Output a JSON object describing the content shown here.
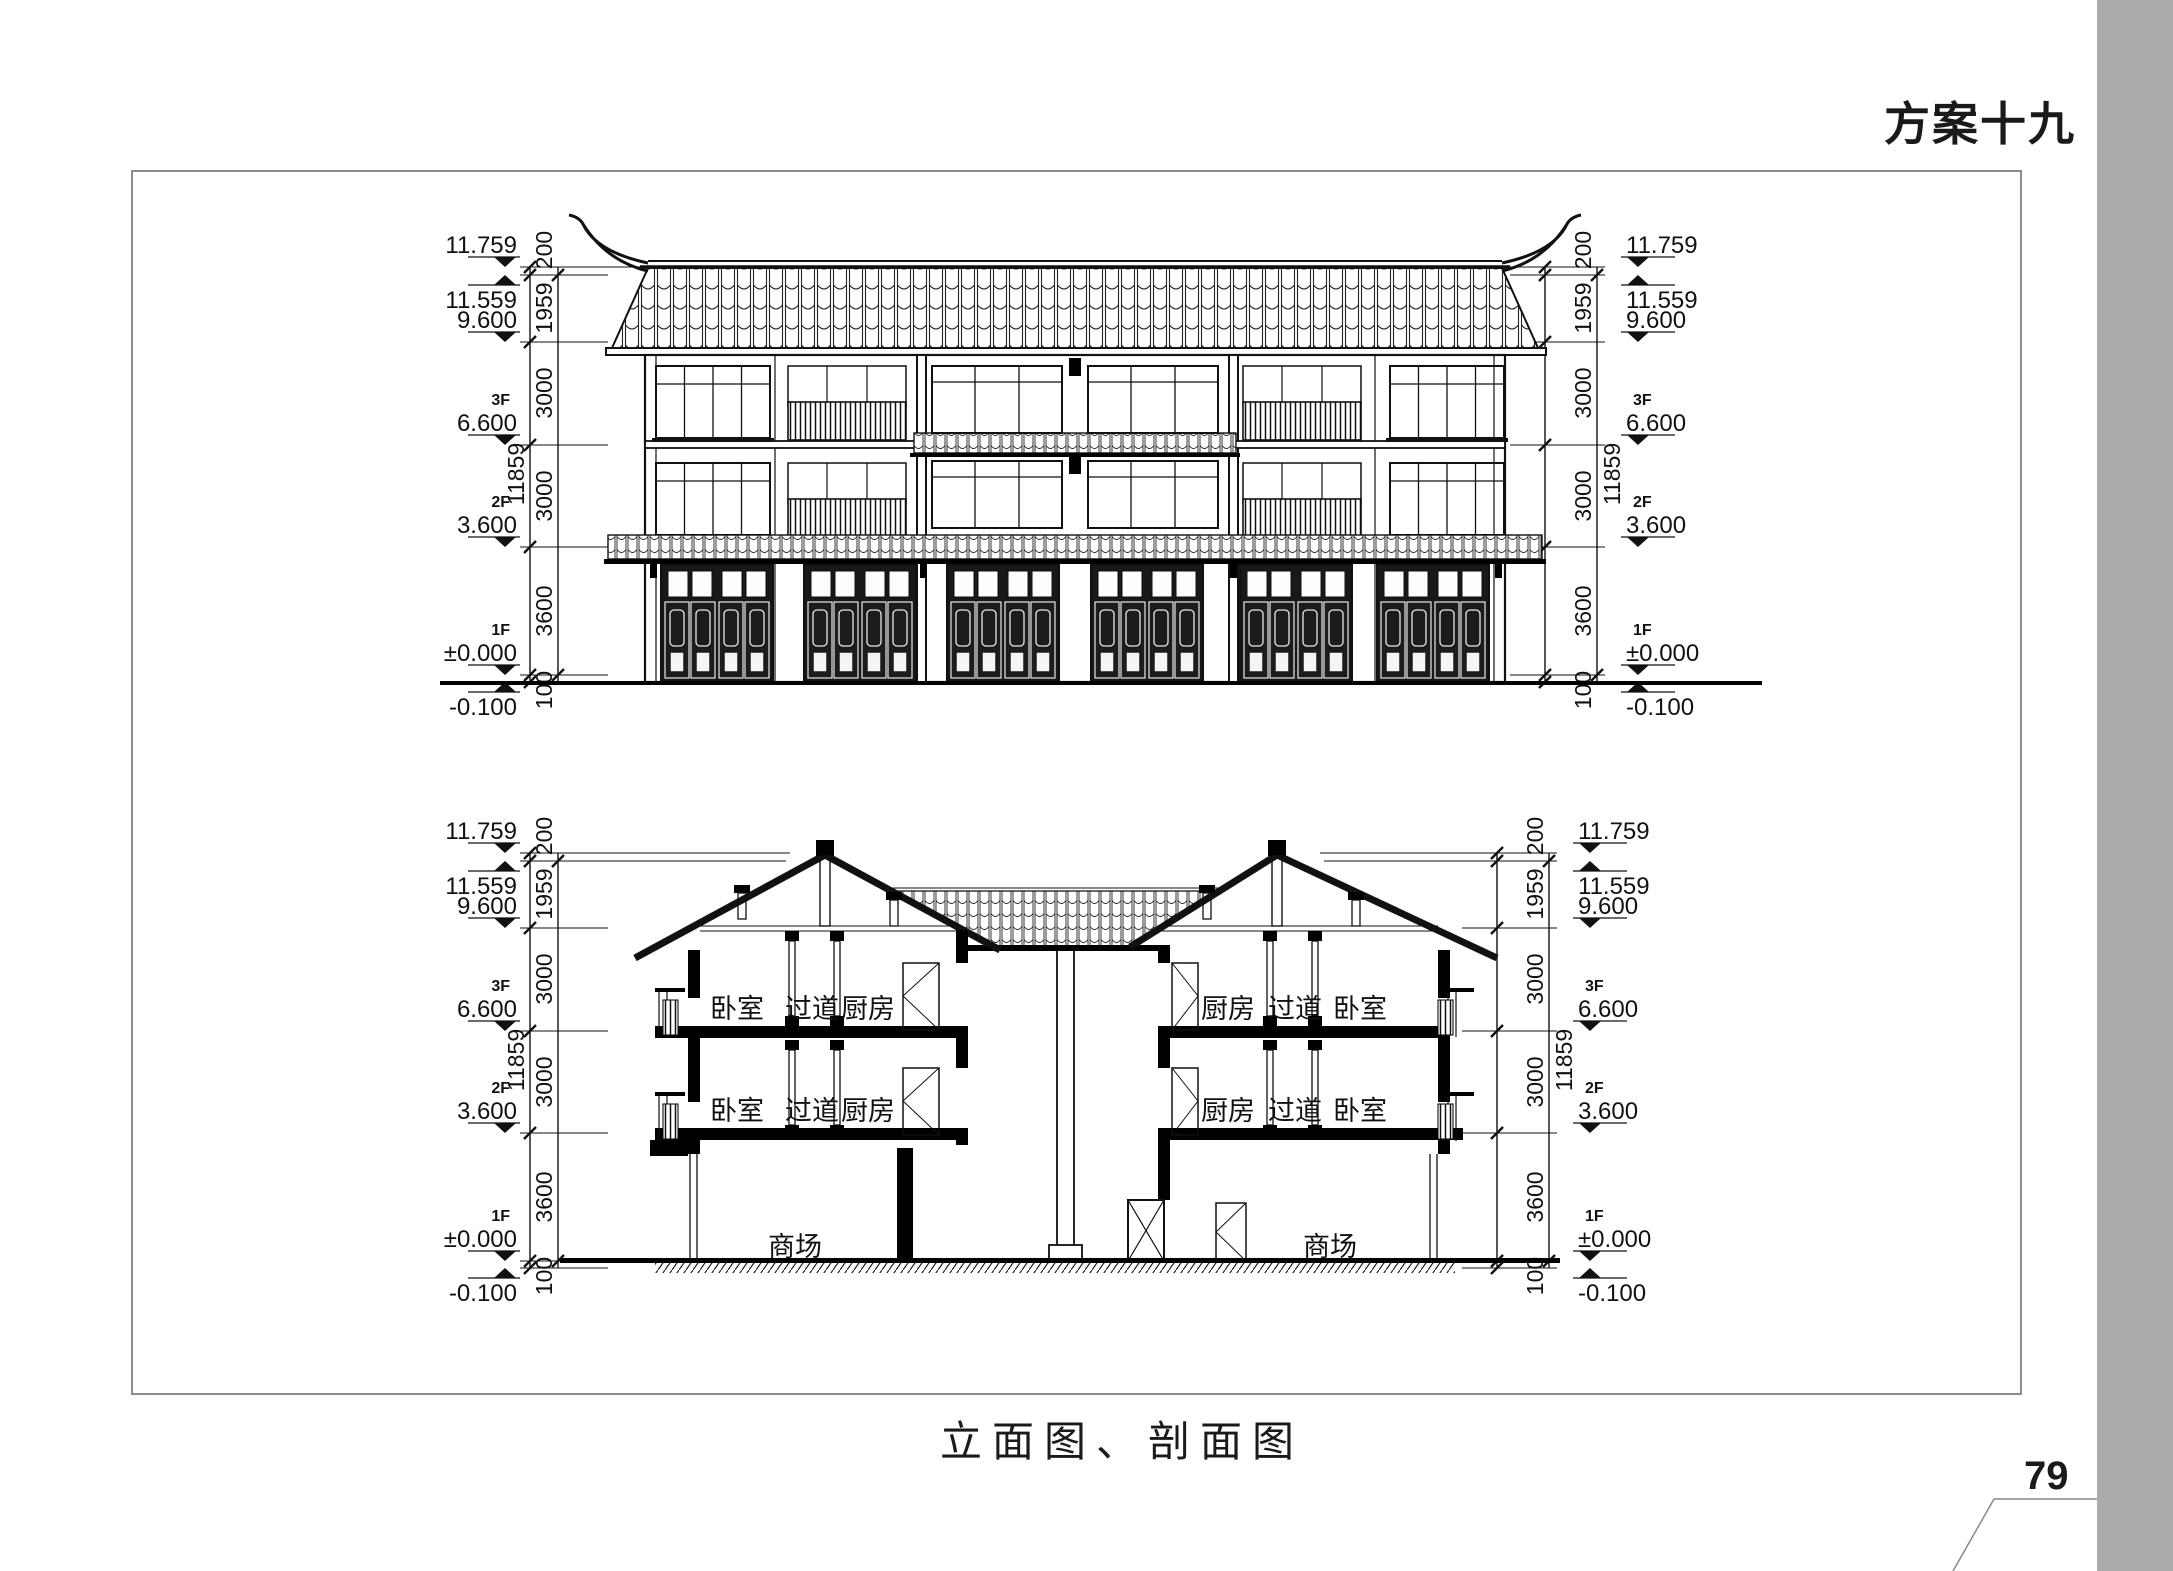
{
  "page": {
    "title": "方案十九",
    "caption": "立面图、剖面图",
    "page_number": "79"
  },
  "dimensions": {
    "levels": [
      {
        "tag": "",
        "value": "11.759"
      },
      {
        "tag": "",
        "value": "11.559"
      },
      {
        "tag": "",
        "value": "9.600"
      },
      {
        "tag": "3F",
        "value": "6.600"
      },
      {
        "tag": "2F",
        "value": "3.600"
      },
      {
        "tag": "1F",
        "value": "±0.000"
      },
      {
        "tag": "",
        "value": "-0.100"
      }
    ],
    "segments": [
      "200",
      "1959",
      "3000",
      "3000",
      "3600",
      "100"
    ],
    "overall": "11859"
  },
  "rooms": {
    "left": {
      "f3": [
        "卧室",
        "过道",
        "厨房"
      ],
      "f2": [
        "卧室",
        "过道",
        "厨房"
      ],
      "f1": "商场"
    },
    "right": {
      "f3": [
        "厨房",
        "过道",
        "卧室"
      ],
      "f2": [
        "厨房",
        "过道",
        "卧室"
      ],
      "f1": "商场"
    }
  },
  "colors": {
    "paper": "#ffffff",
    "ink": "#1a1a1a",
    "sidebar_gray": "#ababab",
    "frame_gray": "#8c8c8c"
  }
}
